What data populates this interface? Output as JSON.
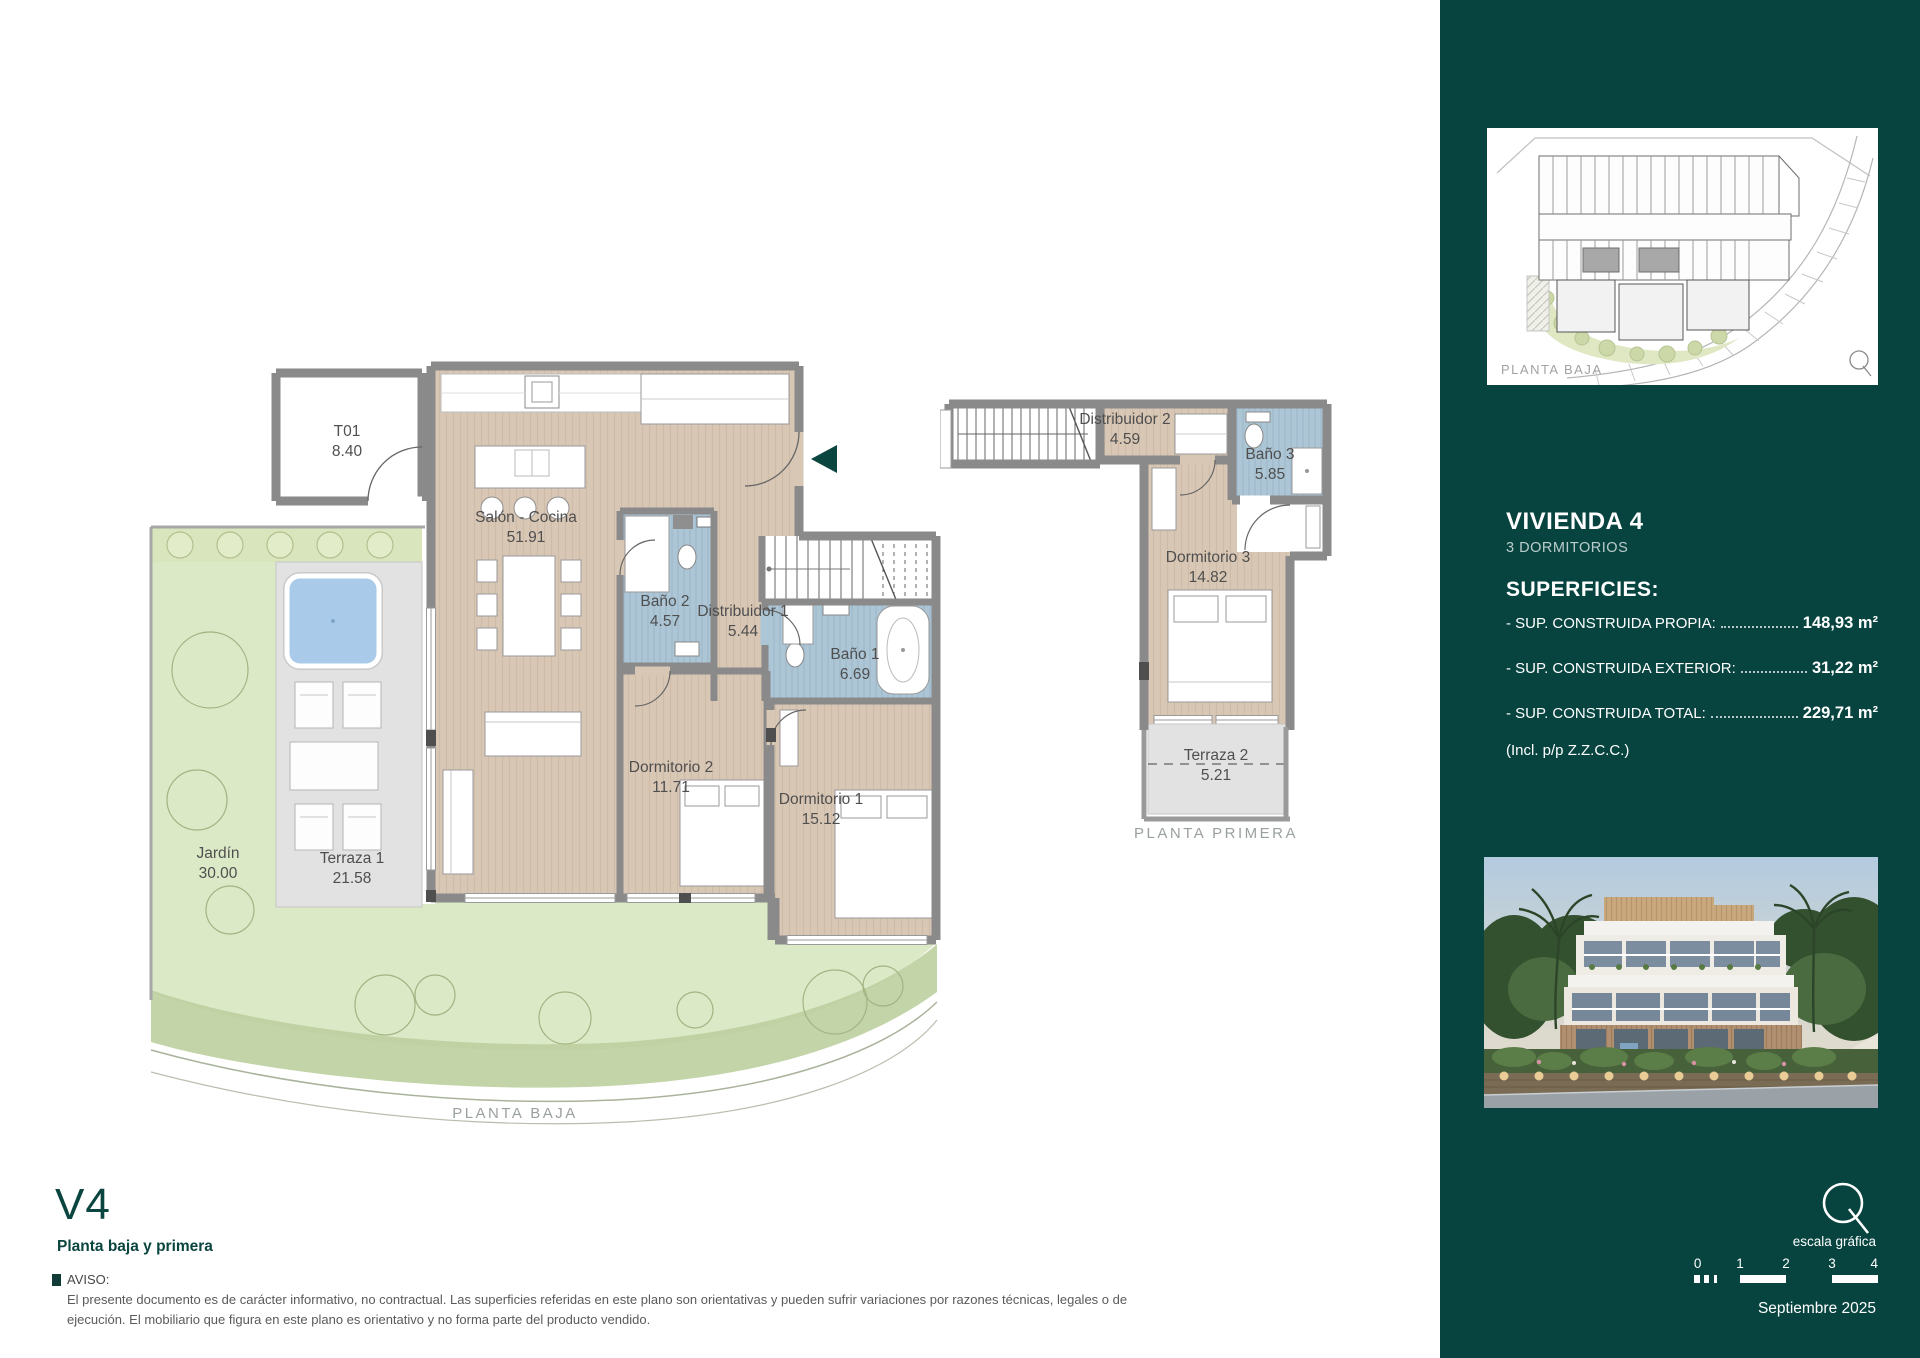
{
  "accent": "#0a453f",
  "sidebar_bg": "#074440",
  "ground_floor": {
    "caption": "PLANTA BAJA",
    "rooms": [
      {
        "id": "t01",
        "name": "T01",
        "area": "8.40"
      },
      {
        "id": "salon-cocina",
        "name": "Salón - Cocina",
        "area": "51.91"
      },
      {
        "id": "bano2",
        "name": "Baño 2",
        "area": "4.57"
      },
      {
        "id": "distribuidor1",
        "name": "Distribuidor 1",
        "area": "5.44"
      },
      {
        "id": "bano1",
        "name": "Baño 1",
        "area": "6.69"
      },
      {
        "id": "dormitorio2",
        "name": "Dormitorio 2",
        "area": "11.71"
      },
      {
        "id": "dormitorio1",
        "name": "Dormitorio 1",
        "area": "15.12"
      },
      {
        "id": "jardin",
        "name": "Jardín",
        "area": "30.00"
      },
      {
        "id": "terraza1",
        "name": "Terraza 1",
        "area": "21.58"
      }
    ]
  },
  "first_floor": {
    "caption": "PLANTA PRIMERA",
    "rooms": [
      {
        "id": "distribuidor2",
        "name": "Distribuidor 2",
        "area": "4.59"
      },
      {
        "id": "bano3",
        "name": "Baño 3",
        "area": "5.85"
      },
      {
        "id": "dormitorio3",
        "name": "Dormitorio 3",
        "area": "14.82"
      },
      {
        "id": "terraza2",
        "name": "Terraza 2",
        "area": "5.21"
      }
    ]
  },
  "sidebar": {
    "site_plan_caption": "PLANTA BAJA",
    "unit_title": "VIVIENDA 4",
    "unit_subtitle": "3 DORMITORIOS",
    "surfaces_title": "SUPERFICIES:",
    "surfaces": [
      {
        "label": "- SUP. CONSTRUIDA PROPIA:",
        "value": "148,93 m²"
      },
      {
        "label": "- SUP. CONSTRUIDA EXTERIOR:",
        "value": "31,22 m²"
      },
      {
        "label": "- SUP. CONSTRUIDA TOTAL:",
        "value": "229,71 m²"
      }
    ],
    "surfaces_note": "(Incl. p/p Z.Z.C.C.)",
    "scale_label": "escala gráfica",
    "scale_ticks": [
      "0",
      "1",
      "2",
      "3",
      "4"
    ],
    "date": "Septiembre 2025"
  },
  "footer": {
    "unit_code": "V4",
    "unit_floors": "Planta baja y primera",
    "notice_title": "AVISO:",
    "notice_text": "El presente documento es de carácter informativo, no contractual. Las superficies referidas en este plano son orientativas y pueden sufrir variaciones por razones técnicas, legales o de ejecución. El mobiliario que figura en este plano es orientativo y no forma parte del producto vendido."
  }
}
